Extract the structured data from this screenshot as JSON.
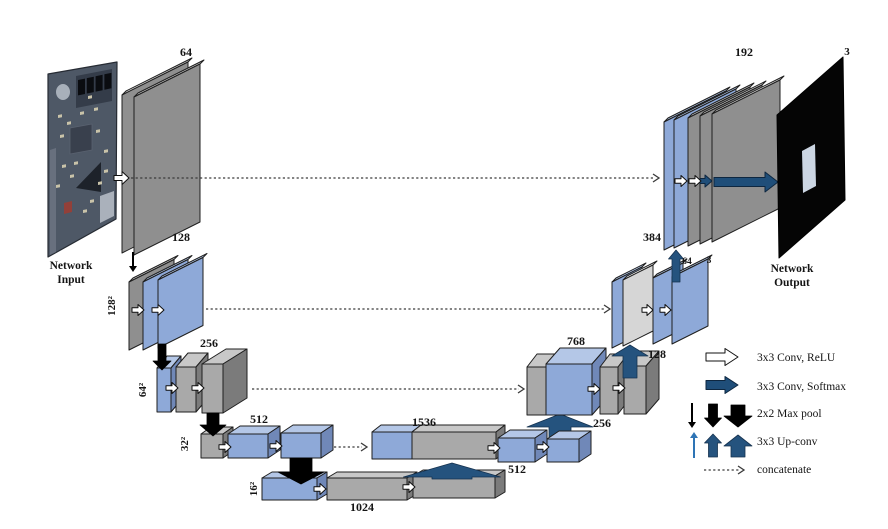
{
  "colors": {
    "background": "#ffffff",
    "outline": "#1f1f1f",
    "gray_face": "#8f8f8f",
    "gray_box_face": "#a9a9a9",
    "gray_top": "#c8c8c8",
    "gray_side": "#7b7b7b",
    "blue_face": "#8ea9d8",
    "blue_top": "#b4c7e7",
    "blue_side": "#7088b8",
    "lightgray_face": "#d6d6d6",
    "lightgray_top": "#ececec",
    "navy_arrow": "#1f4e79",
    "upconv_arrow": "#25537e",
    "upconv_thin": "#2e74b5",
    "black_arrow": "#000000",
    "white_arrow": "#ffffff",
    "dotted_line": "#3a3a3a",
    "pcb_base": "#4e5866",
    "output_black": "#050505",
    "output_inner": "#ccd6e3",
    "text": "#141414"
  },
  "diagram": {
    "input": {
      "caption_line1": "Network",
      "caption_line2": "Input"
    },
    "output": {
      "caption_line1": "Network",
      "caption_line2": "Output",
      "channel_label": "3"
    },
    "encoder": {
      "level1_channels": "64",
      "level2_channels": "128",
      "level2_size": "128²",
      "level3_channels": "256",
      "level3_size": "64²",
      "level4_channels": "512",
      "level4_size": "32²",
      "bottleneck_channels": "1024",
      "bottleneck_size": "16²"
    },
    "decoder": {
      "level4_concat_channels": "1536",
      "level4_conv_channels": "512",
      "level3_concat_channels": "768",
      "level3_conv_channels": "256",
      "level3_top_channels": "128",
      "level2_concat_channels": "384",
      "level2_conv_channels": "64",
      "level2_out_channels": "3",
      "level1_concat_channels": "192"
    }
  },
  "legend": {
    "conv_relu": "3x3 Conv, ReLU",
    "conv_softmax": "3x3 Conv, Softmax",
    "max_pool": "2x2 Max pool",
    "up_conv": "3x3 Up-conv",
    "concatenate": "concatenate"
  }
}
